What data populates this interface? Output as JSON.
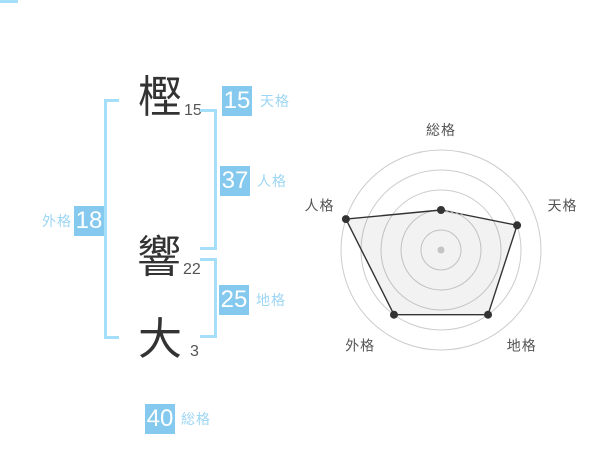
{
  "name": {
    "chars": [
      {
        "char": "樫",
        "strokes": "15"
      },
      {
        "char": "響",
        "strokes": "22"
      },
      {
        "char": "大",
        "strokes": "3"
      }
    ]
  },
  "badges": {
    "tenkaku": {
      "value": "15",
      "label": "天格"
    },
    "jinkaku": {
      "value": "37",
      "label": "人格"
    },
    "chikaku": {
      "value": "25",
      "label": "地格"
    },
    "gaikaku": {
      "value": "18",
      "label": "外格"
    },
    "soukaku": {
      "value": "40",
      "label": "総格"
    }
  },
  "colors": {
    "badge": "#85CAEE",
    "badge_label": "#9DD6F4",
    "bracket": "#A5DEF8",
    "kanji": "#333333",
    "stroke_count": "#555555",
    "grid": "#CCCCCC",
    "polygon_stroke": "#333333",
    "polygon_fill": "rgba(0,0,0,0.05)",
    "center_dot": "#C4C4C4",
    "axis_label": "#555555",
    "dashed_detail": "#AAAAAA"
  },
  "chart_data": {
    "type": "radar",
    "axes": [
      "総格",
      "天格",
      "地格",
      "外格",
      "人格"
    ],
    "values": [
      40,
      80,
      80,
      80,
      100
    ],
    "rings": [
      20,
      40,
      60,
      80,
      100
    ],
    "max": 100,
    "grid_shape": "circular",
    "spokes": false,
    "legend": false,
    "title": ""
  }
}
